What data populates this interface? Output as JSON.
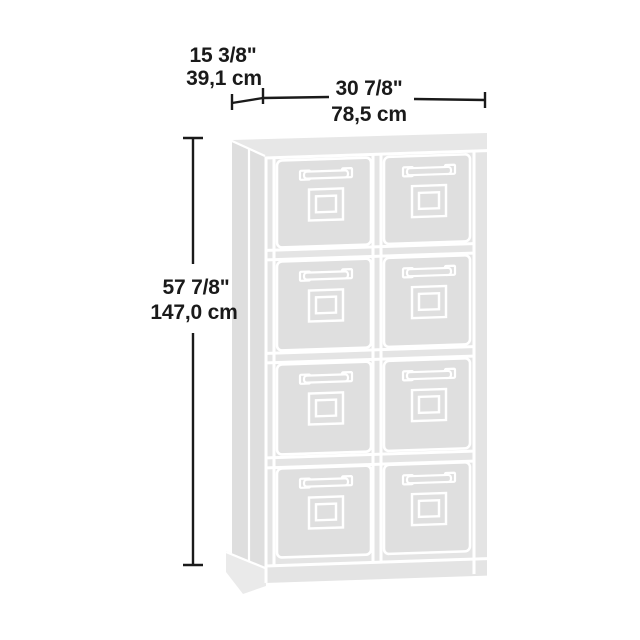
{
  "title": "8-cube storage cabinet dimension diagram",
  "dimensions": {
    "depth": {
      "inches": "15 3/8\"",
      "cm": "39,1 cm"
    },
    "width": {
      "inches": "30 7/8\"",
      "cm": "78,5 cm"
    },
    "height": {
      "inches": "57 7/8\"",
      "cm": "147,0 cm"
    }
  },
  "cabinet": {
    "rows": 4,
    "columns": 2,
    "bin_count": 8,
    "bin_features": [
      "pull-handle",
      "label-holder"
    ]
  },
  "colors": {
    "background": "#ffffff",
    "dimension_line": "#1a1a1a",
    "text": "#1a1a1a",
    "cabinet_body": "#e4e4e4",
    "cabinet_bin": "#dfdfdf",
    "cabinet_outline": "#ffffff"
  }
}
